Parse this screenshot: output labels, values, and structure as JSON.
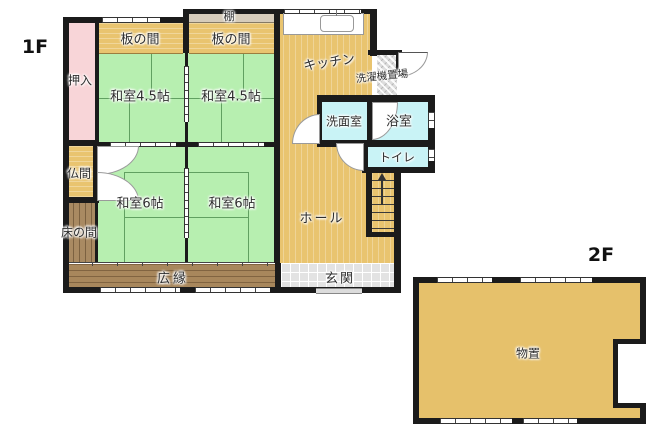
{
  "floors": {
    "f1": "1F",
    "f2": "2F"
  },
  "rooms": {
    "oshiire": "押入",
    "itanoma1": "板の間",
    "tana": "棚",
    "itanoma2": "板の間",
    "kitchen": "キッチン",
    "laundry": "洗濯機置場",
    "washitsu45a": "和室4.5帖",
    "washitsu45b": "和室4.5帖",
    "senmen": "洗面室",
    "bath": "浴室",
    "toilet": "トイレ",
    "butsuma": "仏間",
    "washitsu6a": "和室6帖",
    "washitsu6b": "和室6帖",
    "hall": "ホール",
    "tokonoma": "床の間",
    "hiroen": "広縁",
    "genkan": "玄関",
    "monooki": "物置"
  },
  "colors": {
    "tatami_green": "#b7efb0",
    "wood_tan": "#e9c46f",
    "bath_cyan": "#c9f3f6",
    "closet_pink": "#f8d5d8",
    "veranda_brown": "#a8875c",
    "tokonoma_brown": "#a98a62",
    "entrance_gray": "#e3e3e3",
    "shelf_beige": "#d6ccbb",
    "wall_black": "#1b1b1b"
  }
}
